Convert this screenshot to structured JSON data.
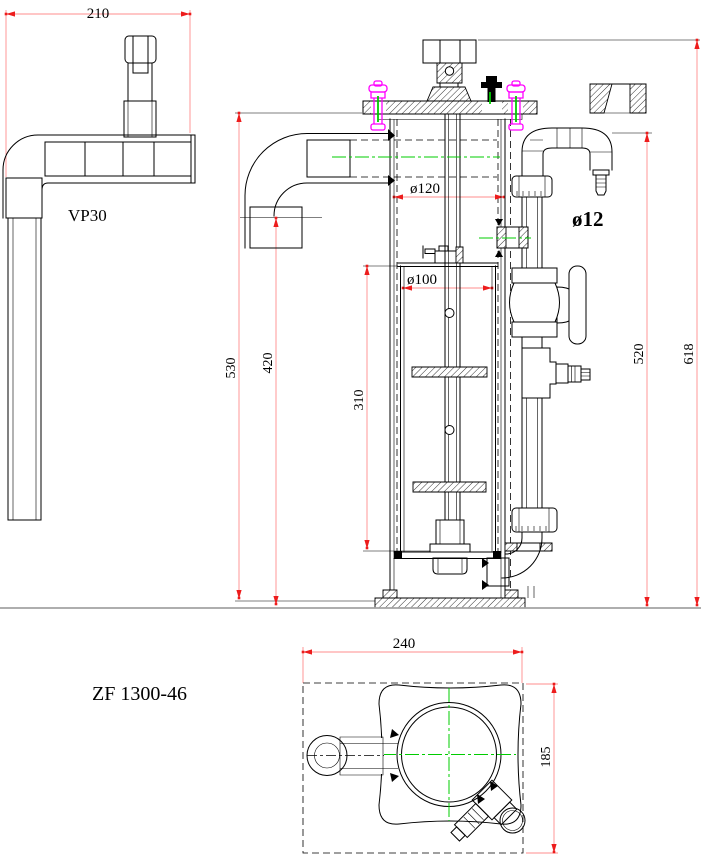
{
  "labels": {
    "model": "ZF 1300-46",
    "pipe_standard": "VP30"
  },
  "dims": {
    "w210": "210",
    "d120": "ø120",
    "d100": "ø100",
    "d12": "ø12",
    "h530": "530",
    "h420": "420",
    "h310": "310",
    "h520": "520",
    "h618": "618",
    "w240": "240",
    "w185": "185"
  },
  "colors": {
    "line": "#000000",
    "dimension_line": "#ff8c8c",
    "dimension_arrow": "#ed1c1c",
    "centerline": "#00cc00",
    "bolt_highlight": "#ff00ff",
    "ground_line": "#a3a3a3",
    "background": "#ffffff"
  }
}
